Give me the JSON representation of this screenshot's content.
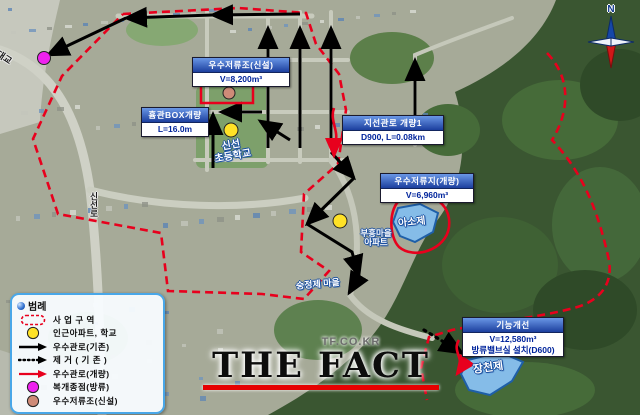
{
  "annotations": {
    "storage_new": {
      "title": "우수저류조(신설)",
      "line1": "V=8,200m³"
    },
    "hume_box": {
      "title": "흄관BOX개량",
      "line1": "L=16.0m"
    },
    "branch_pipe": {
      "title": "지선관로 개량1",
      "line1": "D900, L=0.08km"
    },
    "storage_imp": {
      "title": "우수저류지(개량)",
      "line1": "V=6,960m³"
    },
    "function_imp": {
      "title": "기능개선",
      "line1": "V=12,580m³",
      "line2": "방류밸브실 설치(D600)"
    }
  },
  "places": {
    "school_line1": "신선",
    "school_line2": "초등학교",
    "apt_line1": "부흥마을",
    "apt_line2": "아파트",
    "village": "숭정제 마을",
    "pond_upper": "아소제",
    "pond_lower": "장천제",
    "road_bridge": "남항대교",
    "road_vertical": "신선로",
    "compass_n": "N"
  },
  "legend": {
    "title": "범례",
    "items": [
      {
        "symbol": "project-area",
        "label": "사 업 구 역"
      },
      {
        "symbol": "poi-circle",
        "label": "인근아파트, 학교"
      },
      {
        "symbol": "existing-pipe",
        "label": "우수관로(기존)"
      },
      {
        "symbol": "removal-pipe",
        "label": "제 거 ( 기 존 )"
      },
      {
        "symbol": "improved-pipe",
        "label": "우수관로(개량)"
      },
      {
        "symbol": "outlet-point",
        "label": "복개종점(방류)"
      },
      {
        "symbol": "new-storage",
        "label": "우수저류조(신설)"
      }
    ]
  },
  "watermark": {
    "site": "TF.CO.KR",
    "brand": "THE FACT"
  },
  "colors": {
    "boundary_red": "#e8001d",
    "pipe_existing": "#000000",
    "pipe_improved": "#e8001d",
    "poi_yellow": "#ffe227",
    "outlet_magenta": "#ee22ee",
    "storage_salmon": "#cf8b78",
    "pond_blue": "#85bce8",
    "forest_green": "#3a5631"
  }
}
